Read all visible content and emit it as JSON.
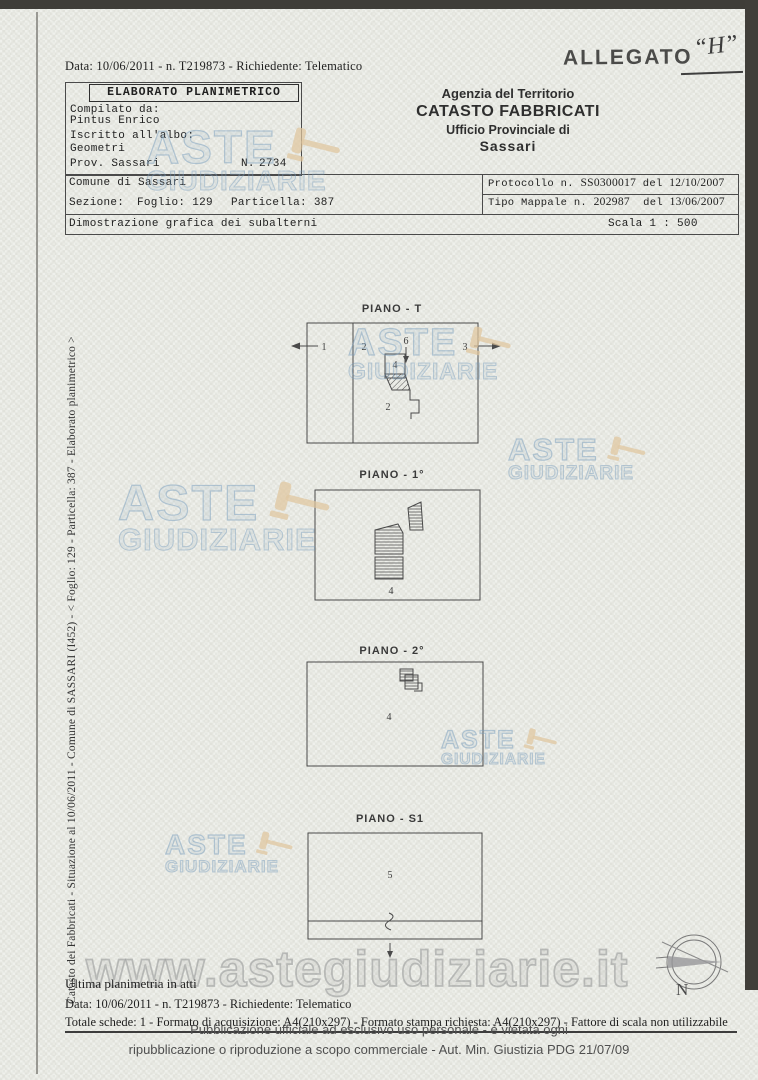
{
  "document": {
    "top_line": "Data: 10/06/2011 - n. T219873 - Richiedente: Telematico",
    "allegato_label": "ALLEGATO",
    "allegato_value": "“H”"
  },
  "elaborato_box": {
    "title": "ELABORATO PLANIMETRICO",
    "compilato_label": "Compilato da:",
    "compilato_value": "Pintus Enrico",
    "iscritto_label": "Iscritto all'albo:",
    "iscritto_value": "Geometri",
    "prov_label": "Prov. Sassari",
    "n_label": "N.",
    "n_value": "2734"
  },
  "agency": {
    "line1": "Agenzia del Territorio",
    "line2": "CATASTO FABBRICATI",
    "line3": "Ufficio Provinciale di",
    "line4": "Sassari"
  },
  "info": {
    "comune": "Comune di Sassari",
    "sezione_label": "Sezione:",
    "foglio": "Foglio: 129",
    "particella": "Particella: 387",
    "protocollo_label": "Protocollo n.",
    "protocollo_number": "SS0300017",
    "protocollo_del": "del",
    "protocollo_date": "12/10/2007",
    "mappale_label": "Tipo Mappale n.",
    "mappale_number": "202987",
    "mappale_del": "del",
    "mappale_date": "13/06/2007",
    "dimostrazione": "Dimostrazione grafica dei subalterni",
    "scala": "Scala 1 : 500"
  },
  "side_text": "Catasto dei Fabbricati - Situazione al 10/06/2011 - Comune di SASSARI (I452) - < Foglio: 129 - Particella: 387 - Elaborato planimetrico >",
  "plans": {
    "t": {
      "label": "PIANO - T",
      "n1": "1",
      "n2": "2",
      "n6": "6",
      "n3": "3",
      "n4": "4",
      "n2b": "2"
    },
    "p1": {
      "label": "PIANO - 1°",
      "n4": "4"
    },
    "p2": {
      "label": "PIANO - 2°",
      "n4": "4"
    },
    "s1": {
      "label": "PIANO - S1",
      "n5": "5"
    }
  },
  "compass": {
    "north": "N"
  },
  "watermark": {
    "word1": "ASTE",
    "word2": "GIUDIZIARIE",
    "url": "www.astegiudiziarie.it"
  },
  "footer": {
    "ultima": "Ultima planimetria in atti",
    "data_line": "Data: 10/06/2011 - n. T219873 - Richiedente: Telematico",
    "totale_line": "Totale schede: 1 - Formato di acquisizione: A4(210x297) - Formato stampa richiesta: A4(210x297) - Fattore di scala non utilizzabile",
    "overlay_line1": "Pubblicazione ufficiale ad esclusivo uso personale - è vietata ogni",
    "overlay_line2": "ripubblicazione o riproduzione a scopo commerciale - Aut. Min. Giustizia PDG 21/07/09"
  },
  "colors": {
    "watermark_blue": "#7fa2c0",
    "gavel_tan": "#e0c69e",
    "scan_bar": "#3f3d38"
  }
}
